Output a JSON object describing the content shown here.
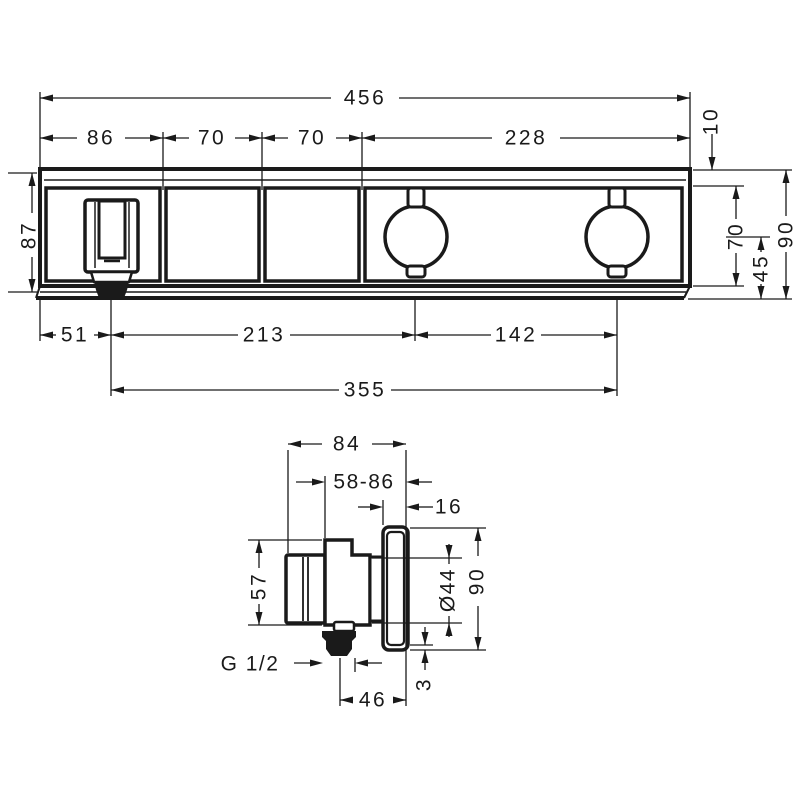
{
  "front_view": {
    "total_width": "456",
    "segment_1": "86",
    "segment_2": "70",
    "segment_3": "70",
    "segment_4": "228",
    "top_edge": "10",
    "module_height": "87",
    "inner_height": "70",
    "handle_center_height": "45",
    "total_height": "90",
    "outlet_offset": "51",
    "outlet_to_handle1": "213",
    "handle_spacing": "142",
    "outlet_to_handle2": "355"
  },
  "side_view": {
    "depth": "84",
    "installation_depth_range": "58-86",
    "escutcheon_thickness": "16",
    "body_height": "57",
    "sleeve_diameter": "Ø44",
    "escutcheon_height": "90",
    "edge_gap": "3",
    "thread_size": "G 1/2",
    "projection": "46"
  }
}
